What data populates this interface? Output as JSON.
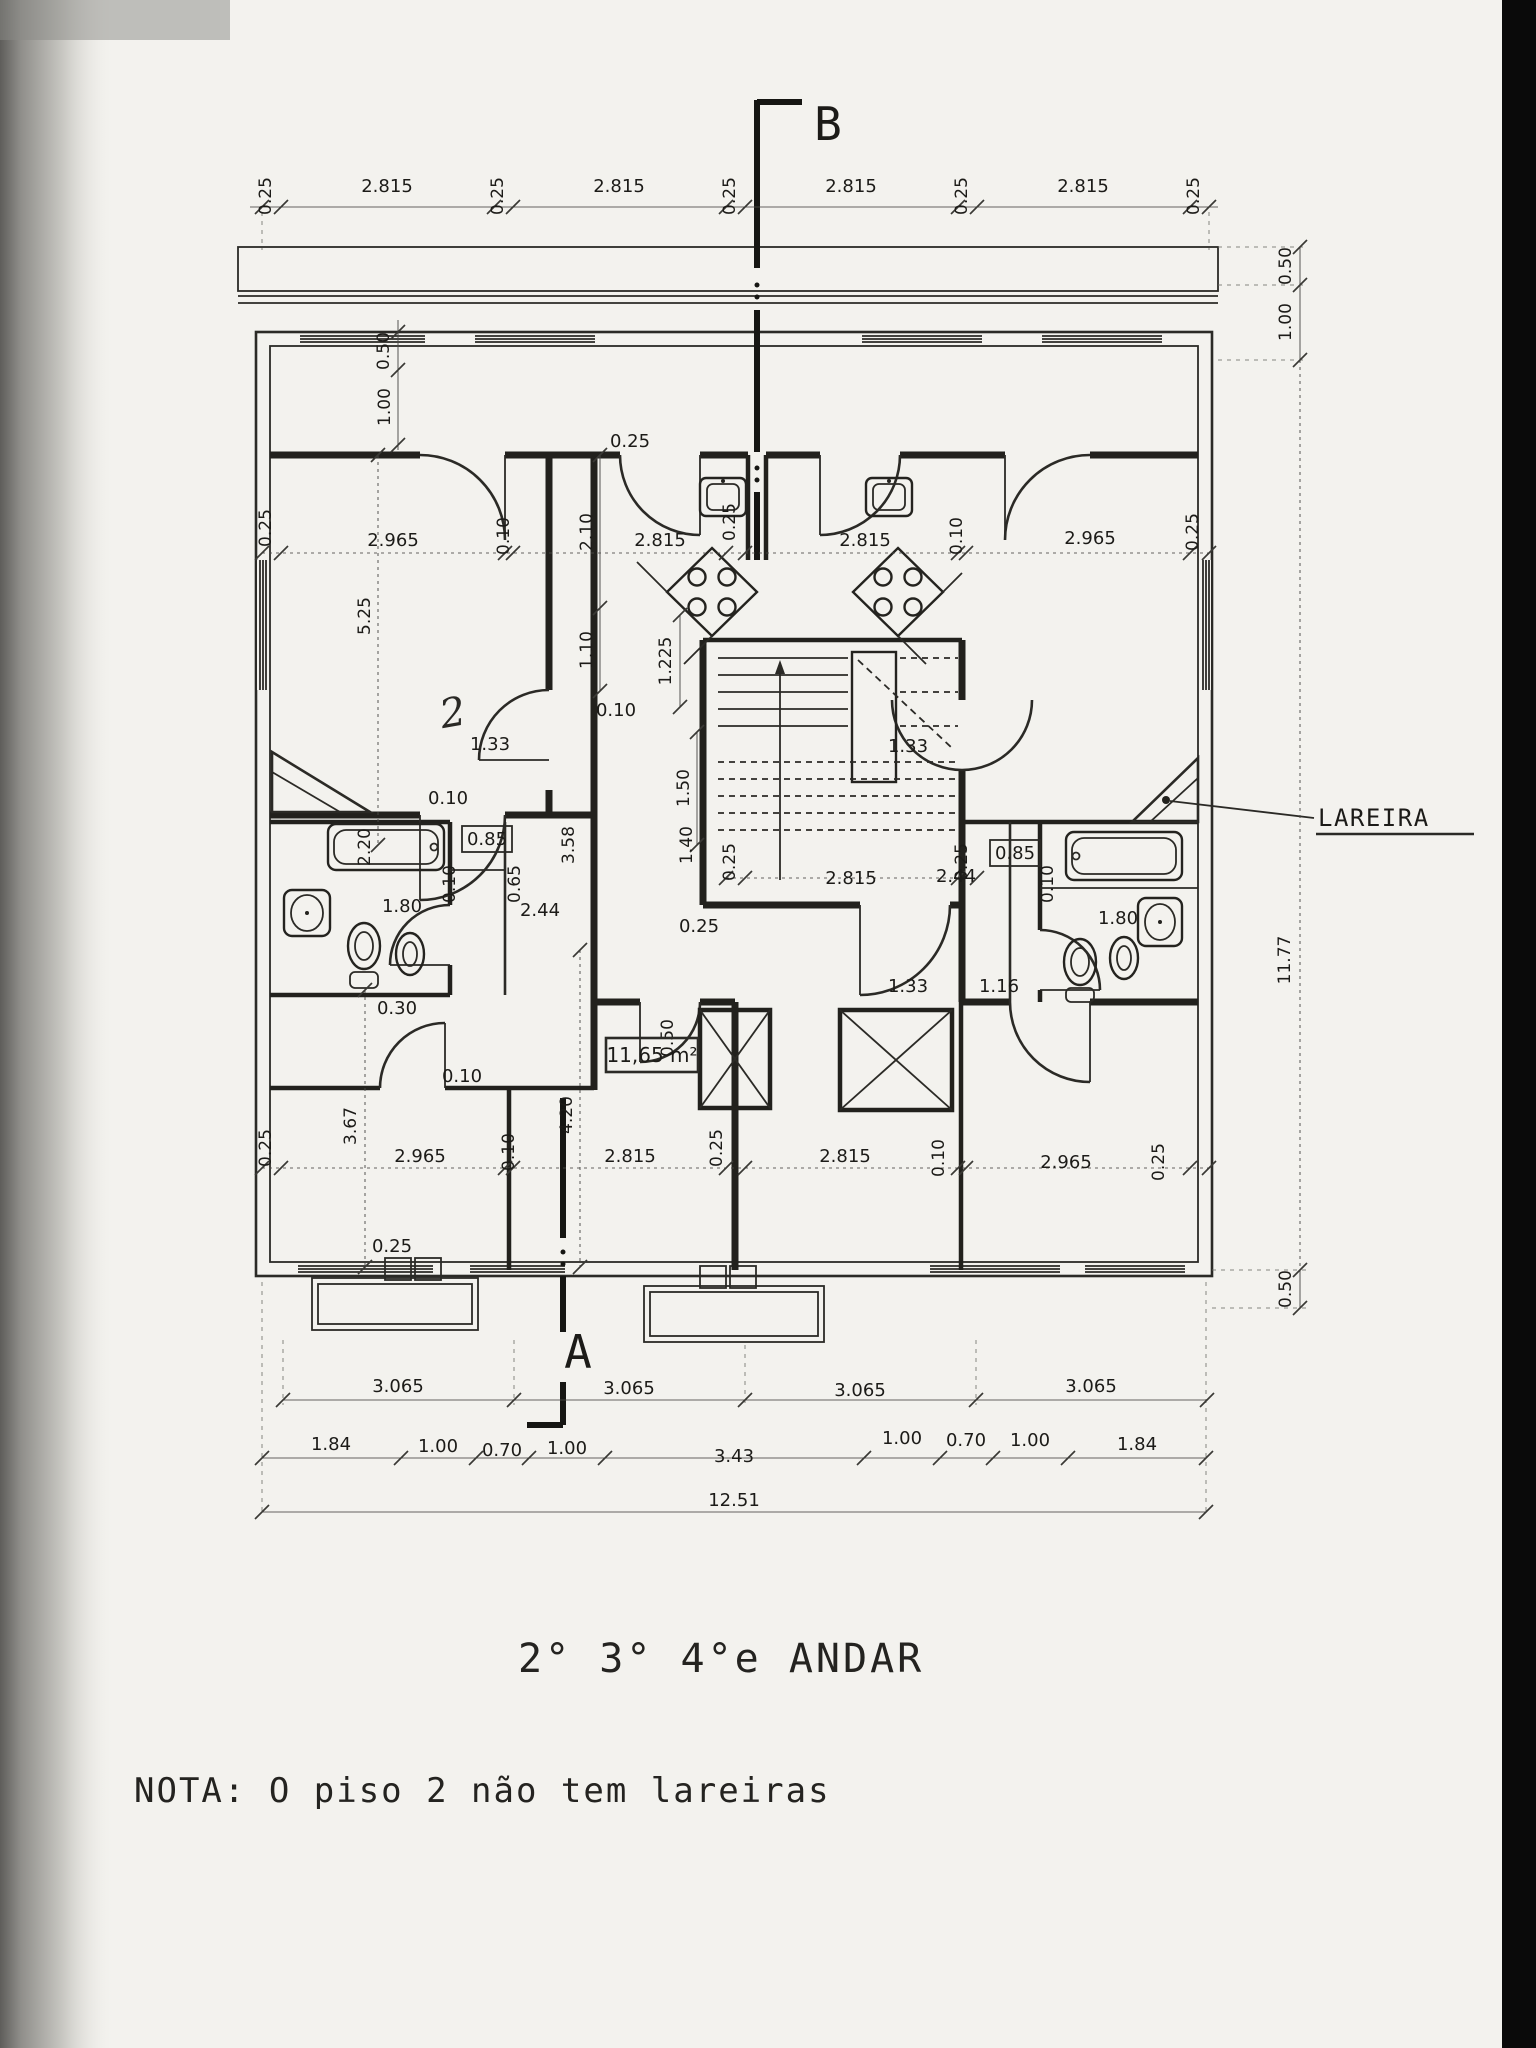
{
  "colors": {
    "paper": "#f3f2ee",
    "ink": "#22211d",
    "dim_text": "#1c1b18",
    "scan_edge": "#0a0a0a"
  },
  "titles": {
    "floor": "2° 3° 4°e ANDAR",
    "note": "NOTA: O  piso 2 não tem lareiras"
  },
  "sections": {
    "top": "B",
    "bottom": "A"
  },
  "labels": {
    "fireplace": "LAREIRA",
    "area": "11,65 m²",
    "handwritten": "2"
  },
  "dims": {
    "top": [
      "0.25",
      "2.815",
      "0.25",
      "2.815",
      "0.25",
      "2.815",
      "0.25",
      "2.815",
      "0.25"
    ],
    "rowTop": [
      "0.25",
      "2.965",
      "0.10",
      "2.815",
      "0.25",
      "2.815",
      "0.10",
      "2.965",
      "0.25"
    ],
    "rowBottom": [
      "0.25",
      "2.965",
      "0.10",
      "2.815",
      "0.25",
      "2.815",
      "0.10",
      "2.965",
      "0.25"
    ],
    "bays": [
      "3.065",
      "3.065",
      "3.065",
      "3.065"
    ],
    "detail": [
      "1.84",
      "1.00",
      "0.70",
      "1.00",
      "3.43",
      "1.00",
      "0.70",
      "1.00",
      "1.84"
    ],
    "total": "12.51",
    "right": [
      "0.50",
      "1.00",
      "11.77",
      "0.50"
    ],
    "leftInner": [
      "0.50",
      "1.00"
    ],
    "verticals": {
      "livingHeight": "5.25",
      "lowerLeft": "3.67",
      "lowerMid": "4.20",
      "corr1": "2.10",
      "corr2": "1.10",
      "stairLanding": "1.225",
      "stairFlight": "1.50",
      "corrLower": "3.58"
    },
    "doors": {
      "left": "1.33",
      "right": "1.33",
      "lowerRight": "1.33",
      "lowerRight2": "1.16",
      "kitchen": "0.25"
    },
    "hall": {
      "w1": "0.25",
      "w2": "2.815",
      "w3": "0.25",
      "depth": "1.40",
      "shaft": "0.50",
      "wall": "0.25"
    },
    "bathLeft": {
      "tub": "2.20",
      "width": "1.80",
      "step": "0.30",
      "closet": "0.85",
      "c065": "0.65",
      "c244": "2.44",
      "w010": "0.10"
    },
    "bathRight": {
      "closet": "0.85",
      "width": "1.80",
      "w010": "0.10",
      "c244": "2.44"
    },
    "walls": {
      "a010": "0.10",
      "b010": "0.10",
      "c010": "0.10",
      "d025": "0.25"
    }
  }
}
